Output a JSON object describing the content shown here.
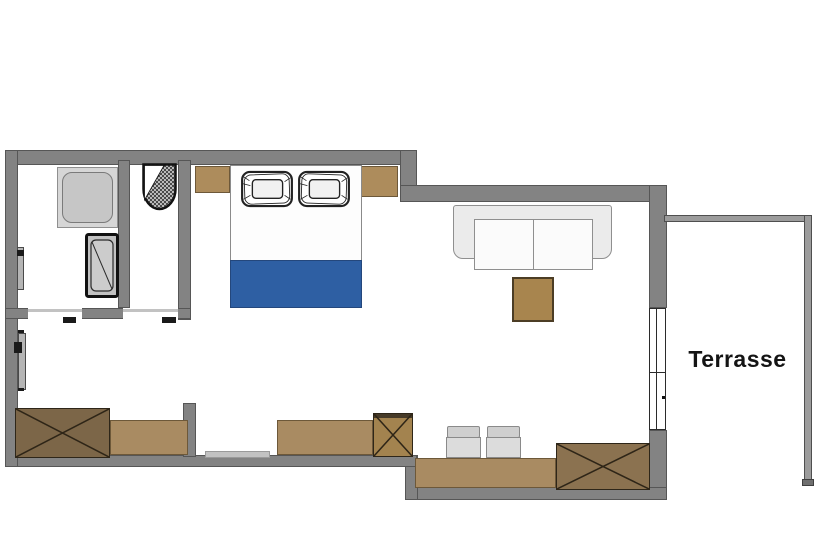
{
  "plan": {
    "label_terrasse": "Terrasse",
    "rooms": [
      {
        "name": "bathroom-shower-room"
      },
      {
        "name": "washbasin-niche"
      },
      {
        "name": "sleeping-area"
      },
      {
        "name": "living-dining-area"
      },
      {
        "name": "terrace",
        "label": "Terrasse"
      }
    ],
    "furniture": [
      {
        "name": "shower"
      },
      {
        "name": "washbasin-unit"
      },
      {
        "name": "hatched-basin"
      },
      {
        "name": "entrance-door"
      },
      {
        "name": "double-bed",
        "blanket_color": "#2e5fa3",
        "pillows": 2
      },
      {
        "name": "nightstand",
        "count": 2
      },
      {
        "name": "sofa",
        "seats": 2
      },
      {
        "name": "coffee-table"
      },
      {
        "name": "crossed-wardrobe",
        "count": 3
      },
      {
        "name": "dresser"
      },
      {
        "name": "sideboard"
      },
      {
        "name": "dining-counter"
      },
      {
        "name": "chair",
        "count": 2
      },
      {
        "name": "terrace-window"
      }
    ],
    "colors": {
      "wall": "#838383",
      "wall_outline": "#565656",
      "wood_light": "#a98b62",
      "wood_dark": "#7c6648",
      "wood_mid": "#8b7250",
      "coffee_table": "#a8854e",
      "blanket_blue": "#2e5fa3",
      "fixture_gray": "#c6c6c6",
      "sofa_gray": "#ebebeb",
      "chair_gray": "#dcdcdc",
      "background": "#ffffff",
      "text": "#141414"
    }
  }
}
